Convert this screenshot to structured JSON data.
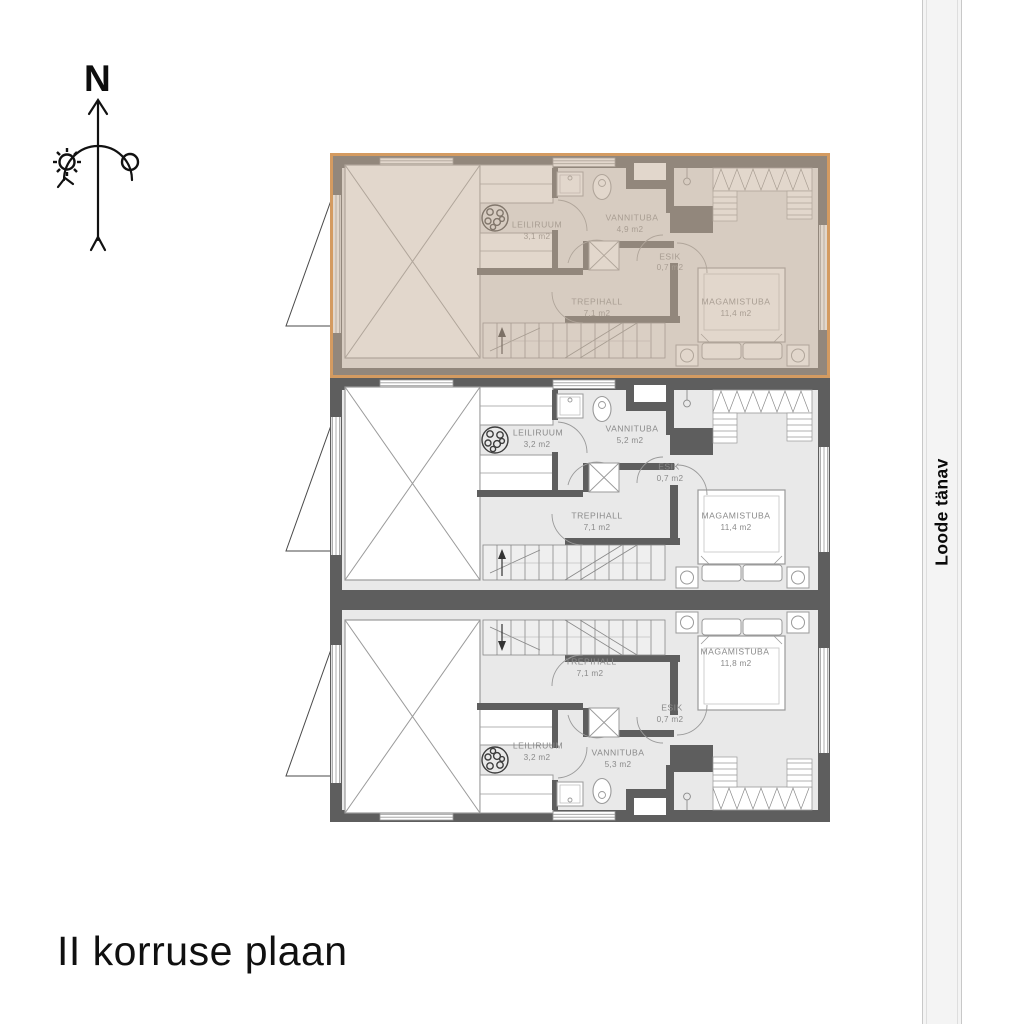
{
  "title": "II korruse plaan",
  "street": {
    "name": "Loode tänav"
  },
  "compass": {
    "north_label": "N"
  },
  "colors": {
    "highlight_border": "#d49b61",
    "highlight_fill": "rgba(198,176,154,0.5)",
    "wall": "#5e5e5e",
    "room_fill": "#e9e9e9",
    "label_text": "#8a8a8a",
    "street_fill": "#f4f4f4"
  },
  "units": [
    {
      "id": "unit-top",
      "highlighted": true,
      "rooms": [
        {
          "name": "LEILIRUUM",
          "area": "3,1 m2"
        },
        {
          "name": "VANNITUBA",
          "area": "4,9 m2"
        },
        {
          "name": "ESIK",
          "area": "0,7 m2"
        },
        {
          "name": "TREPIHALL",
          "area": "7,1 m2"
        },
        {
          "name": "MAGAMISTUBA",
          "area": "11,4 m2"
        }
      ]
    },
    {
      "id": "unit-middle",
      "highlighted": false,
      "rooms": [
        {
          "name": "LEILIRUUM",
          "area": "3,2 m2"
        },
        {
          "name": "VANNITUBA",
          "area": "5,2 m2"
        },
        {
          "name": "ESIK",
          "area": "0,7 m2"
        },
        {
          "name": "TREPIHALL",
          "area": "7,1 m2"
        },
        {
          "name": "MAGAMISTUBA",
          "area": "11,4 m2"
        }
      ]
    },
    {
      "id": "unit-bottom",
      "highlighted": false,
      "rooms": [
        {
          "name": "LEILIRUUM",
          "area": "3,2 m2"
        },
        {
          "name": "VANNITUBA",
          "area": "5,3 m2"
        },
        {
          "name": "ESIK",
          "area": "0,7 m2"
        },
        {
          "name": "TREPIHALL",
          "area": "7,1 m2"
        },
        {
          "name": "MAGAMISTUBA",
          "area": "11,8 m2"
        }
      ]
    }
  ]
}
